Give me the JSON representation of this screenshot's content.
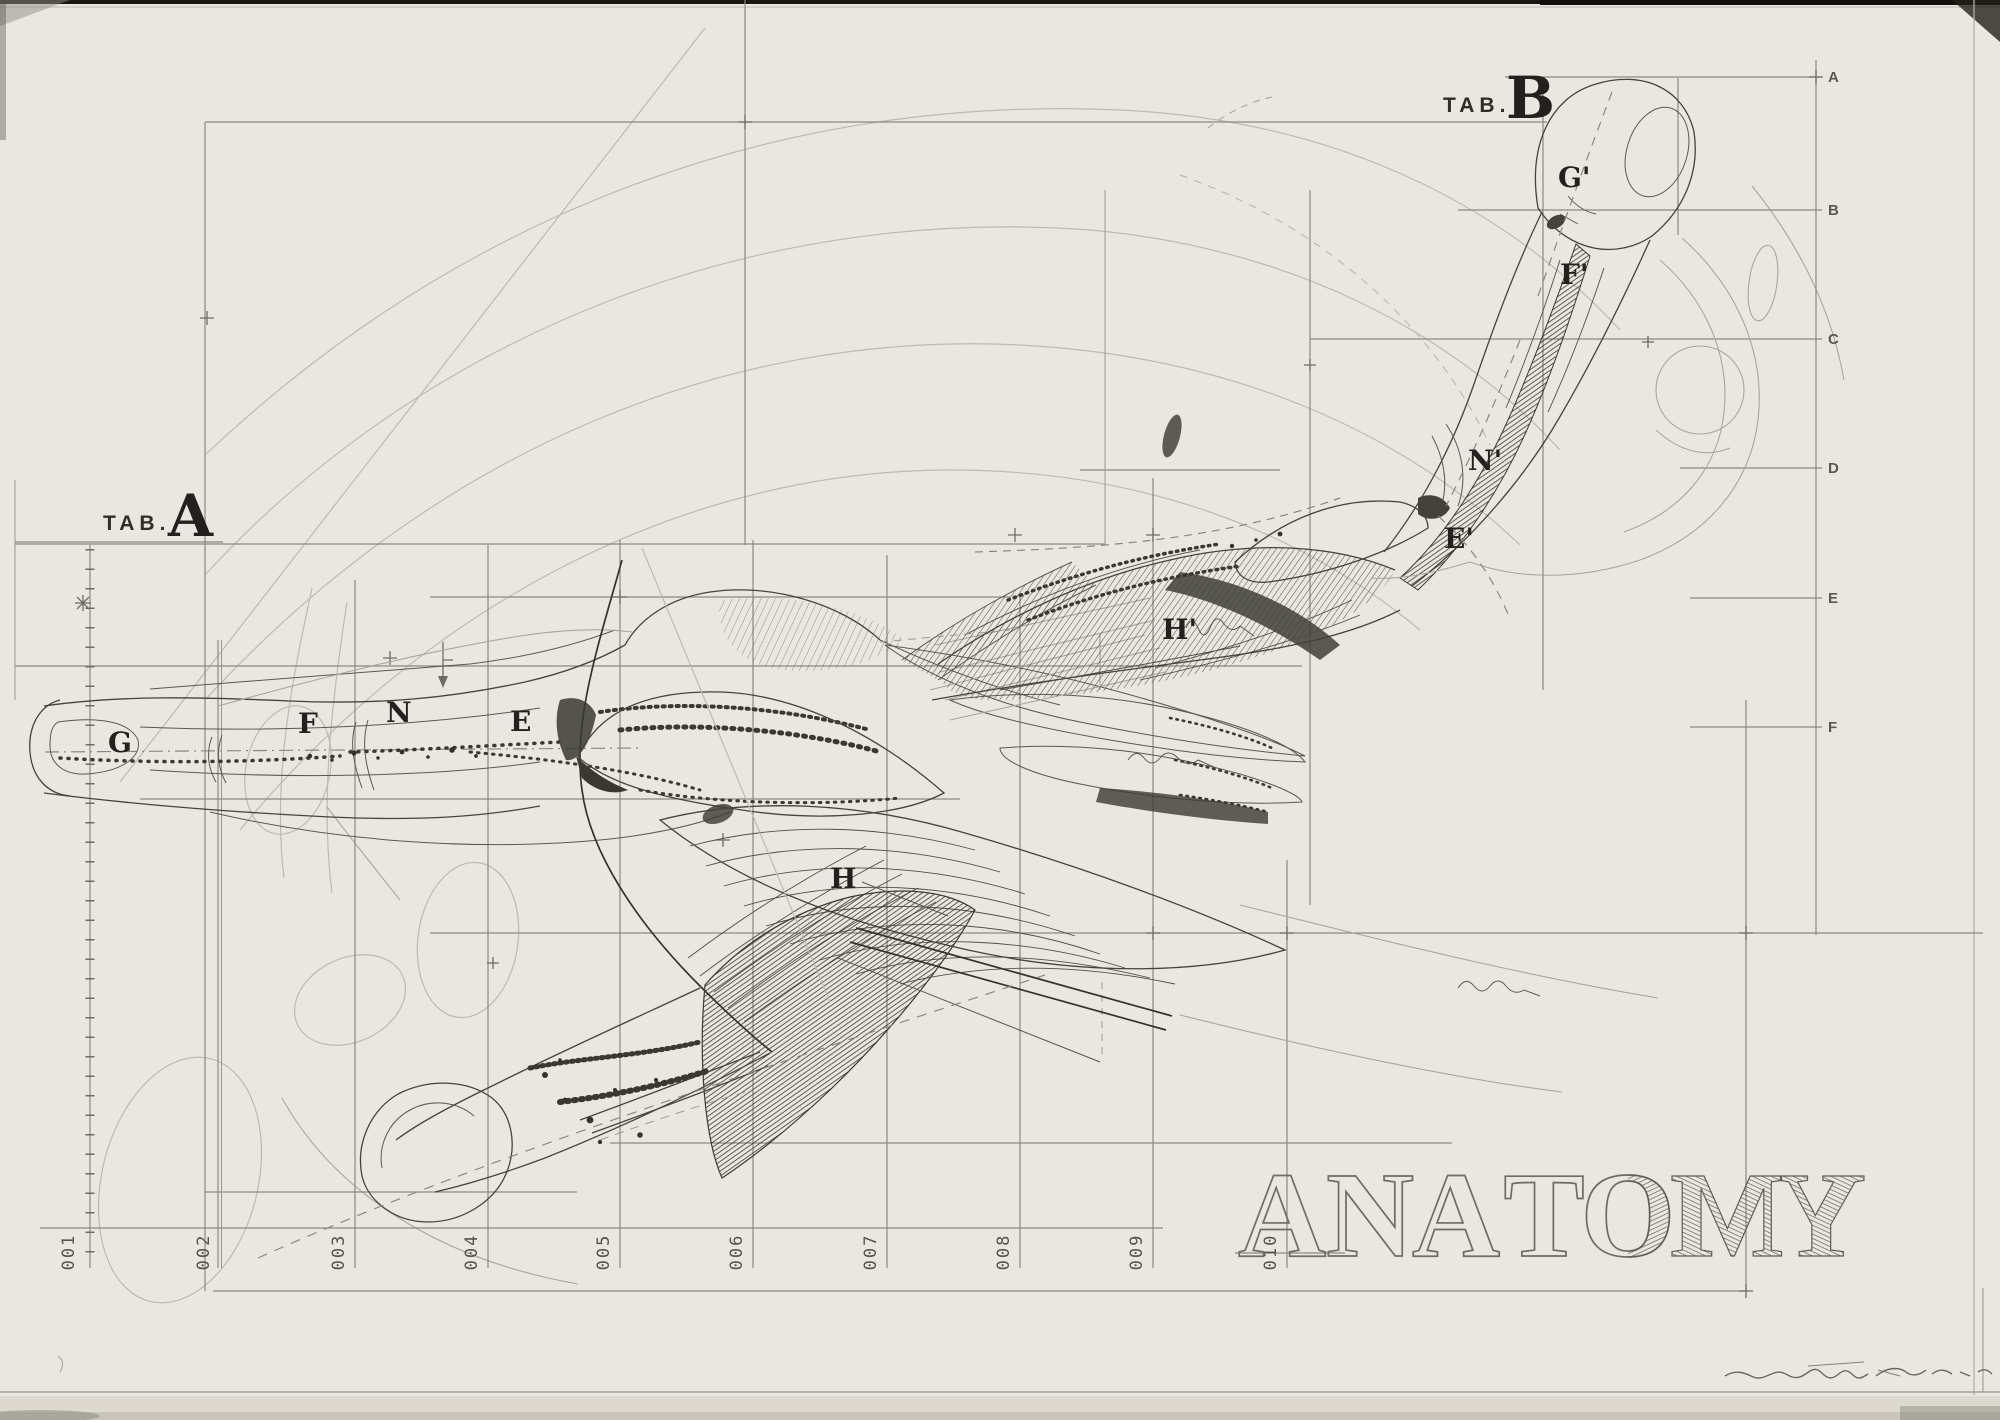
{
  "plate": {
    "tab_a": {
      "prefix": "TAB.",
      "letter": "A"
    },
    "tab_b": {
      "prefix": "TAB.",
      "letter": "B"
    },
    "figure_a_labels": [
      "G",
      "F",
      "N",
      "E",
      "H"
    ],
    "figure_b_labels": [
      "G'",
      "F'",
      "N'",
      "E'",
      "H'"
    ],
    "right_scale": [
      "A",
      "B",
      "C",
      "D",
      "E",
      "F"
    ],
    "bottom_scale": [
      "001",
      "002",
      "003",
      "004",
      "005",
      "006",
      "007",
      "008",
      "009",
      "010"
    ],
    "title_word": {
      "text": "ANATOMY",
      "letters": [
        "A",
        "N",
        "A",
        "T",
        "O",
        "M",
        "Y"
      ]
    },
    "colors": {
      "paper": "#eae7e0",
      "ink": "#45433c",
      "grid": "#8a887f",
      "pencil": "#bdbab0",
      "label": "#22211d",
      "title_outline": "#6e6c63"
    }
  }
}
